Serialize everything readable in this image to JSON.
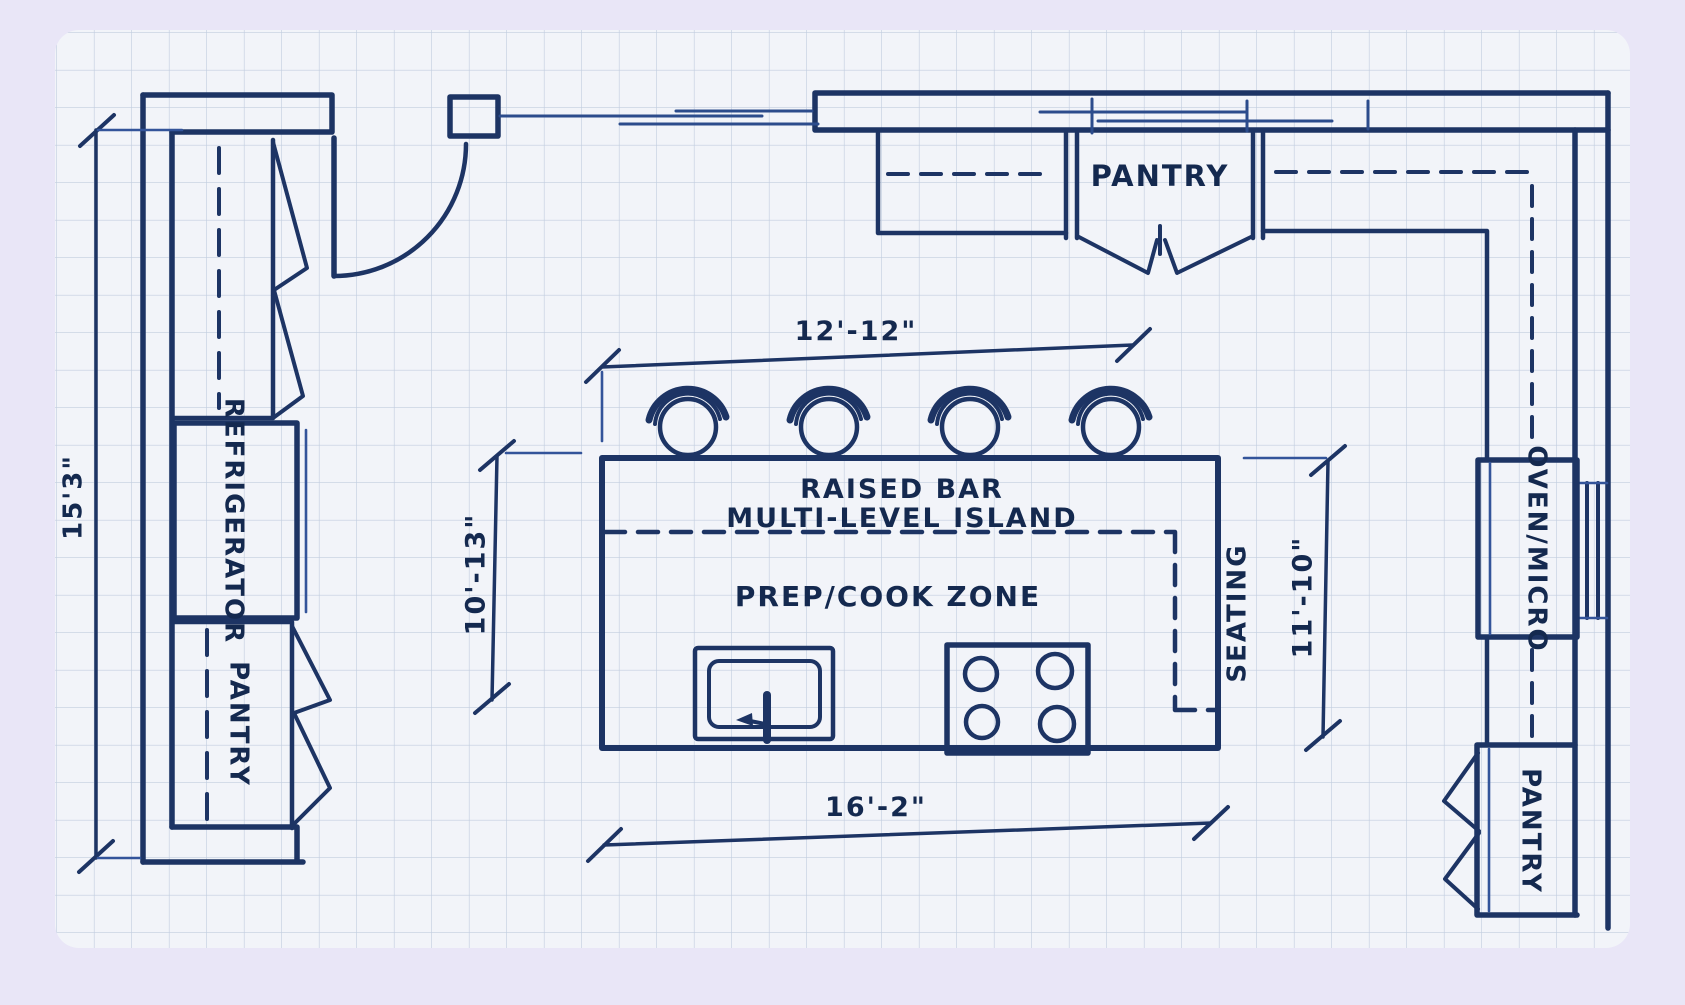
{
  "title": "Hand-drawn kitchen floor plan on graph paper",
  "colors": {
    "background": "#e9e6f7",
    "paper": "#f2f4f9",
    "grid": "#b9c7db",
    "ink": "#1d3464",
    "text": "#14294f"
  },
  "labels": {
    "pantry_top": "PANTRY",
    "refrigerator": "REFRIGERATOR",
    "pantry_left": "PANTRY",
    "raised_bar": "RAISED BAR",
    "multi_level_island": "MULTI-LEVEL ISLAND",
    "prep_cook_zone": "PREP/COOK ZONE",
    "seating": "SEATING",
    "oven_micro": "OVEN/MICRO",
    "pantry_bottom": "PANTRY"
  },
  "dimensions": {
    "left_wall_height": "15'3\"",
    "island_top_width": "12'-12\"",
    "island_left_height": "10'-13\"",
    "island_right_height": "11'-10\"",
    "island_bottom_width": "16'-2\""
  },
  "fixtures": {
    "bar_stools": 4,
    "cooktop_burners": 4,
    "sinks": 1,
    "entry_doors": 1,
    "bifold_door_sets": 3,
    "windows": 3
  }
}
